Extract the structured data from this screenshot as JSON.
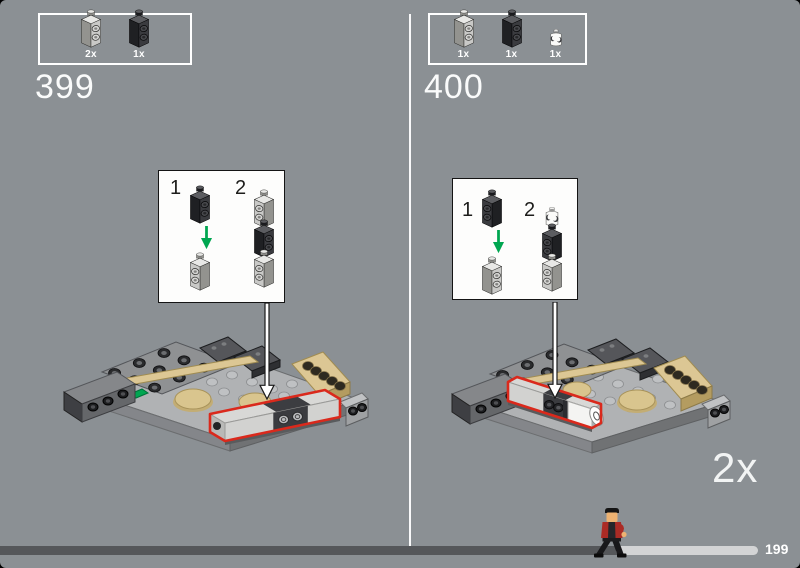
{
  "page": {
    "background": "#8b9094",
    "repeat_label": "2x"
  },
  "steps": [
    {
      "number": "399",
      "parts": [
        {
          "count": "2x",
          "part": "brick-1x1x2-two-side-studs",
          "color_name": "light-gray",
          "color": "#c9c9c7"
        },
        {
          "count": "1x",
          "part": "brick-1x1x2-two-side-studs",
          "color_name": "black",
          "color": "#3a3b3f"
        }
      ],
      "substeps": [
        {
          "label": "1"
        },
        {
          "label": "2"
        }
      ]
    },
    {
      "number": "400",
      "parts": [
        {
          "count": "1x",
          "part": "brick-1x1x2-two-side-studs",
          "color_name": "light-gray",
          "color": "#c9c9c7"
        },
        {
          "count": "1x",
          "part": "brick-1x1x2-two-side-studs",
          "color_name": "black",
          "color": "#3a3b3f"
        },
        {
          "count": "1x",
          "part": "round-brick-1x1",
          "color_name": "white",
          "color": "#ffffff"
        }
      ],
      "substeps": [
        {
          "label": "1"
        },
        {
          "label": "2"
        }
      ]
    }
  ],
  "progress": {
    "page_number": "199",
    "character": "minifigure-walking"
  },
  "colors": {
    "highlight_red": "#da291c",
    "arrow_green": "#00a650",
    "tan": "#dcc794",
    "progress_dark": "#55575a",
    "progress_light": "#d3d4d5"
  }
}
